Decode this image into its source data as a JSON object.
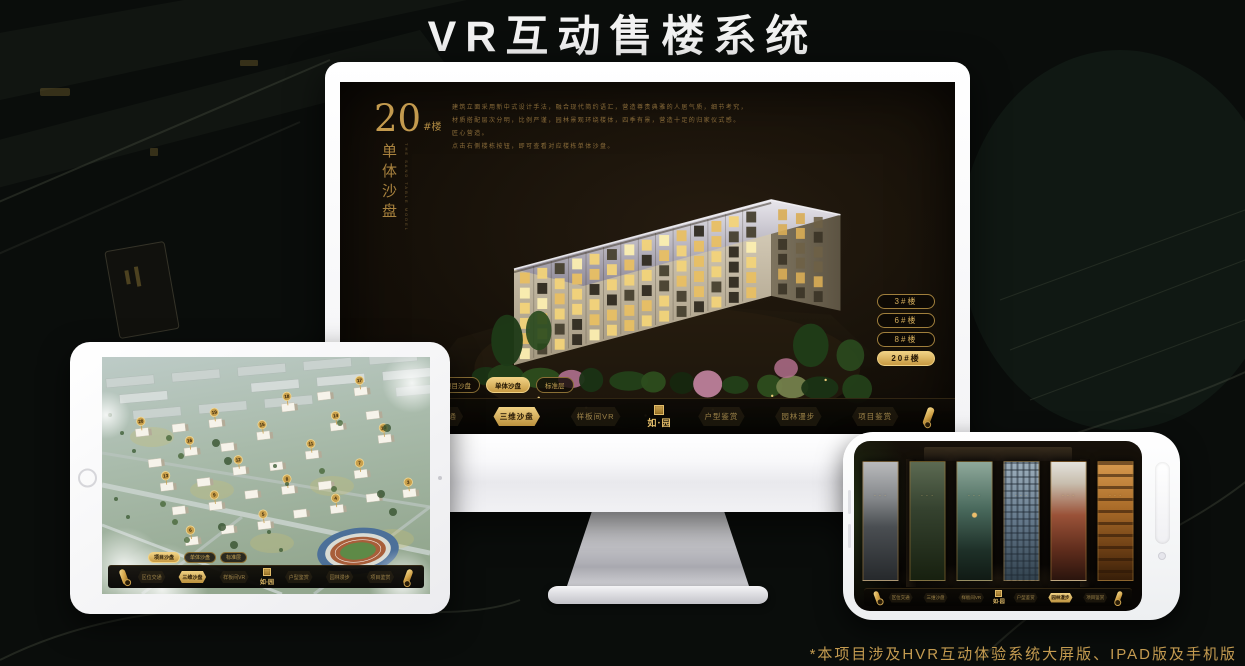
{
  "page": {
    "title": "VR互动售楼系统",
    "footnote": "*本项目涉及HVR互动体验系统大屏版、IPAD版及手机版"
  },
  "brand": {
    "logo_text": "如·园",
    "seal_icon": "gold-seal"
  },
  "colors": {
    "gold": "#c9a14f",
    "gold_bright": "#eccb7c",
    "gold_deep": "#8a6724",
    "text_gold_dim": "#9c8449"
  },
  "monitor": {
    "heading": {
      "number": "20",
      "unit": "#楼",
      "vertical": "单体沙盘",
      "sub_en": "THE SAND TABLE MODEL"
    },
    "description_lines": [
      "建筑立面采用新中式设计手法，融合现代简约语汇，营造尊贵典雅的人居气质，细节考究，",
      "材质搭配层次分明，比例严谨，园林景观环绕楼体，四季有景，营造十足的归家仪式感。",
      "匠心营造。",
      "点击右侧楼栋按钮，即可查看对应楼栋单体沙盘。"
    ],
    "floor_buttons": [
      {
        "label": "3#楼",
        "active": false
      },
      {
        "label": "6#楼",
        "active": false
      },
      {
        "label": "8#楼",
        "active": false
      },
      {
        "label": "20#楼",
        "active": true
      }
    ],
    "sub_tabs": [
      {
        "label": "项目沙盘",
        "active": false
      },
      {
        "label": "单体沙盘",
        "active": true
      },
      {
        "label": "标准层",
        "active": false
      }
    ]
  },
  "tablet": {
    "sub_tabs": [
      {
        "label": "项目沙盘",
        "active": true
      },
      {
        "label": "单体沙盘",
        "active": false
      },
      {
        "label": "标准层",
        "active": false
      }
    ],
    "building_markers": [
      "20",
      "19",
      "18",
      "17",
      "16",
      "15",
      "14",
      "13",
      "12",
      "11",
      "10",
      "9",
      "8",
      "7",
      "6",
      "5",
      "4",
      "3",
      "2",
      "1"
    ]
  },
  "phone": {
    "scene_cards": [
      "courtyard-gray",
      "garden-dark",
      "pavilion-night",
      "facade-blue",
      "autumn-red",
      "interior-warm"
    ]
  },
  "monitor_nav": [
    {
      "label": "区位交通",
      "active": false
    },
    {
      "label": "三维沙盘",
      "active": true
    },
    {
      "label": "样板间VR",
      "active": false
    },
    {
      "label": "户型鉴赏",
      "active": false
    },
    {
      "label": "园林漫步",
      "active": false
    },
    {
      "label": "项目鉴赏",
      "active": false
    }
  ],
  "tablet_nav": [
    {
      "label": "区位交通",
      "active": false
    },
    {
      "label": "三维沙盘",
      "active": true
    },
    {
      "label": "样板间VR",
      "active": false
    },
    {
      "label": "户型鉴赏",
      "active": false
    },
    {
      "label": "园林漫步",
      "active": false
    },
    {
      "label": "项目鉴赏",
      "active": false
    }
  ],
  "phone_nav": [
    {
      "label": "区位交通",
      "active": false
    },
    {
      "label": "三维沙盘",
      "active": false
    },
    {
      "label": "样板间VR",
      "active": false
    },
    {
      "label": "户型鉴赏",
      "active": false
    },
    {
      "label": "园林漫步",
      "active": true
    },
    {
      "label": "项目鉴赏",
      "active": false
    }
  ]
}
